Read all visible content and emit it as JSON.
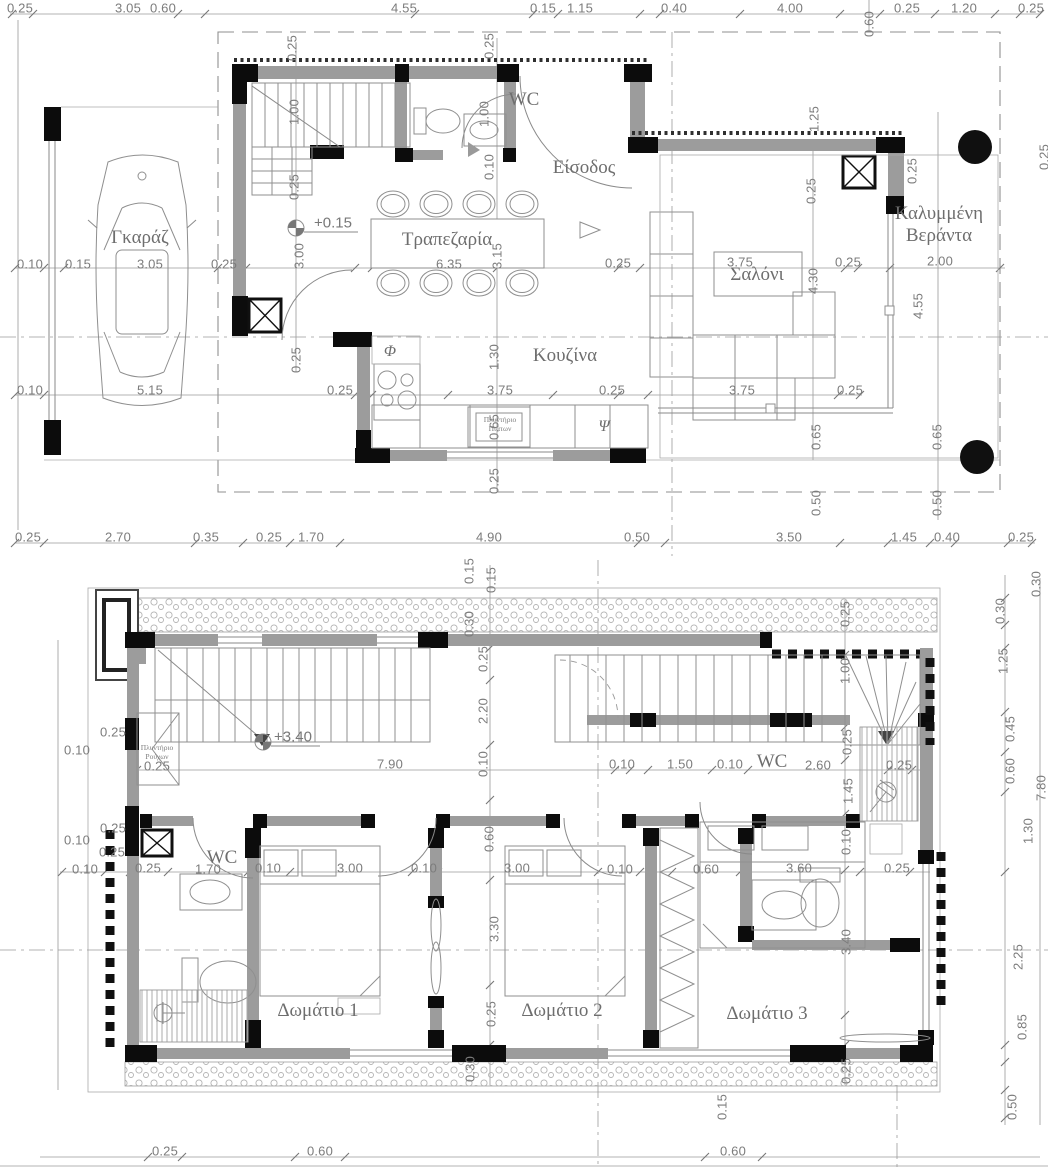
{
  "drawing": {
    "type": "architectural floor plans, two storeys",
    "colors": {
      "wall_black": "#0c0c0c",
      "wall_insulation_gray": "#9c9c9c",
      "line_gray": "#8a8a8a",
      "text_gray": "#7c7c7c"
    }
  },
  "ground_floor": {
    "rooms": [
      {
        "label": "Γκαράζ",
        "x": 140,
        "y": 238
      },
      {
        "label": "Τραπεζαρία",
        "x": 447,
        "y": 240
      },
      {
        "label": "WC",
        "x": 524,
        "y": 100
      },
      {
        "label": "Είσοδος",
        "x": 584,
        "y": 168
      },
      {
        "label": "Κουζίνα",
        "x": 565,
        "y": 356
      },
      {
        "label": "Σαλόνι",
        "x": 757,
        "y": 275
      },
      {
        "label": "Καλυμμένη\nΒεράντα",
        "x": 939,
        "y": 225
      }
    ],
    "fixtures": [
      {
        "label": "Πλυντήριο\nΠιάτων",
        "x": 500,
        "y": 424
      }
    ],
    "symbols": [
      {
        "t": "Φ",
        "x": 390,
        "y": 352
      },
      {
        "t": "Ψ",
        "x": 604,
        "y": 427
      }
    ],
    "level_marker": {
      "t": "+0.15",
      "x": 333,
      "y": 223
    },
    "dimensions": [
      {
        "t": "0.25",
        "x": 20,
        "y": 8
      },
      {
        "t": "3.05",
        "x": 128,
        "y": 8
      },
      {
        "t": "0.60",
        "x": 163,
        "y": 8
      },
      {
        "t": "4.55",
        "x": 404,
        "y": 8
      },
      {
        "t": "0.15",
        "x": 543,
        "y": 8
      },
      {
        "t": "1.15",
        "x": 580,
        "y": 8
      },
      {
        "t": "0.40",
        "x": 674,
        "y": 8
      },
      {
        "t": "4.00",
        "x": 790,
        "y": 8
      },
      {
        "t": "0.60",
        "x": 869,
        "y": 24,
        "v": 1
      },
      {
        "t": "0.25",
        "x": 907,
        "y": 8
      },
      {
        "t": "1.20",
        "x": 964,
        "y": 8
      },
      {
        "t": "0.25",
        "x": 1031,
        "y": 8
      },
      {
        "t": "0.25",
        "x": 292,
        "y": 48,
        "v": 1
      },
      {
        "t": "0.25",
        "x": 489,
        "y": 46,
        "v": 1
      },
      {
        "t": "1.00",
        "x": 294,
        "y": 112,
        "v": 1
      },
      {
        "t": "1.00",
        "x": 484,
        "y": 114,
        "v": 1
      },
      {
        "t": "0.25",
        "x": 294,
        "y": 187,
        "v": 1
      },
      {
        "t": "0.10",
        "x": 489,
        "y": 167,
        "v": 1
      },
      {
        "t": "1.25",
        "x": 814,
        "y": 119,
        "v": 1
      },
      {
        "t": "0.25",
        "x": 811,
        "y": 191,
        "v": 1
      },
      {
        "t": "0.25",
        "x": 912,
        "y": 171,
        "v": 1
      },
      {
        "t": "0.25",
        "x": 1044,
        "y": 157,
        "v": 1
      },
      {
        "t": "0.10",
        "x": 30,
        "y": 264
      },
      {
        "t": "0.15",
        "x": 78,
        "y": 264
      },
      {
        "t": "3.05",
        "x": 150,
        "y": 264
      },
      {
        "t": "0.25",
        "x": 224,
        "y": 264
      },
      {
        "t": "3.00",
        "x": 299,
        "y": 256,
        "v": 1
      },
      {
        "t": "6.35",
        "x": 449,
        "y": 264
      },
      {
        "t": "3.15",
        "x": 497,
        "y": 256,
        "v": 1
      },
      {
        "t": "0.25",
        "x": 618,
        "y": 263
      },
      {
        "t": "3.75",
        "x": 740,
        "y": 262
      },
      {
        "t": "0.25",
        "x": 848,
        "y": 262
      },
      {
        "t": "2.00",
        "x": 940,
        "y": 261
      },
      {
        "t": "4.30",
        "x": 813,
        "y": 281,
        "v": 1
      },
      {
        "t": "4.55",
        "x": 918,
        "y": 306,
        "v": 1
      },
      {
        "t": "0.25",
        "x": 296,
        "y": 360,
        "v": 1
      },
      {
        "t": "1.30",
        "x": 494,
        "y": 357,
        "v": 1
      },
      {
        "t": "0.10",
        "x": 30,
        "y": 390
      },
      {
        "t": "5.15",
        "x": 150,
        "y": 390
      },
      {
        "t": "0.25",
        "x": 340,
        "y": 390
      },
      {
        "t": "3.75",
        "x": 500,
        "y": 390
      },
      {
        "t": "0.25",
        "x": 612,
        "y": 390
      },
      {
        "t": "3.75",
        "x": 742,
        "y": 390
      },
      {
        "t": "0.25",
        "x": 850,
        "y": 390
      },
      {
        "t": "0.65",
        "x": 494,
        "y": 427,
        "v": 1
      },
      {
        "t": "0.25",
        "x": 494,
        "y": 481,
        "v": 1
      },
      {
        "t": "0.65",
        "x": 816,
        "y": 437,
        "v": 1
      },
      {
        "t": "0.65",
        "x": 937,
        "y": 437,
        "v": 1
      },
      {
        "t": "0.50",
        "x": 816,
        "y": 503,
        "v": 1
      },
      {
        "t": "0.50",
        "x": 937,
        "y": 503,
        "v": 1
      },
      {
        "t": "0.25",
        "x": 28,
        "y": 537
      },
      {
        "t": "2.70",
        "x": 118,
        "y": 537
      },
      {
        "t": "0.35",
        "x": 206,
        "y": 537
      },
      {
        "t": "0.25",
        "x": 269,
        "y": 537
      },
      {
        "t": "1.70",
        "x": 311,
        "y": 537
      },
      {
        "t": "4.90",
        "x": 489,
        "y": 537
      },
      {
        "t": "0.50",
        "x": 637,
        "y": 537
      },
      {
        "t": "3.50",
        "x": 789,
        "y": 537
      },
      {
        "t": "1.45",
        "x": 904,
        "y": 537
      },
      {
        "t": "0.40",
        "x": 947,
        "y": 537
      },
      {
        "t": "0.25",
        "x": 1021,
        "y": 537
      }
    ]
  },
  "upper_floor": {
    "rooms": [
      {
        "label": "WC",
        "x": 222,
        "y": 858
      },
      {
        "label": "WC",
        "x": 772,
        "y": 762
      },
      {
        "label": "Δωμάτιο 1",
        "x": 318,
        "y": 1011
      },
      {
        "label": "Δωμάτιο 2",
        "x": 562,
        "y": 1011
      },
      {
        "label": "Δωμάτιο 3",
        "x": 767,
        "y": 1014
      }
    ],
    "fixtures": [
      {
        "label": "Πλυντήριο\nΡούχων",
        "x": 157,
        "y": 752
      }
    ],
    "symbols": [],
    "level_marker": {
      "t": "+3.40",
      "x": 293,
      "y": 737
    },
    "dimensions": [
      {
        "t": "0.15",
        "x": 469,
        "y": 571,
        "v": 1
      },
      {
        "t": "0.15",
        "x": 491,
        "y": 580,
        "v": 1
      },
      {
        "t": "0.30",
        "x": 469,
        "y": 624,
        "v": 1
      },
      {
        "t": "0.25",
        "x": 483,
        "y": 659,
        "v": 1
      },
      {
        "t": "2.20",
        "x": 483,
        "y": 711,
        "v": 1
      },
      {
        "t": "0.10",
        "x": 483,
        "y": 764,
        "v": 1
      },
      {
        "t": "0.25",
        "x": 113,
        "y": 732
      },
      {
        "t": "0.10",
        "x": 77,
        "y": 750
      },
      {
        "t": "0.25",
        "x": 157,
        "y": 766
      },
      {
        "t": "0.25",
        "x": 113,
        "y": 828
      },
      {
        "t": "0.10",
        "x": 77,
        "y": 840
      },
      {
        "t": "0.25",
        "x": 112,
        "y": 852
      },
      {
        "t": "7.90",
        "x": 390,
        "y": 764
      },
      {
        "t": "0.10",
        "x": 622,
        "y": 764
      },
      {
        "t": "1.50",
        "x": 680,
        "y": 764
      },
      {
        "t": "0.10",
        "x": 730,
        "y": 764
      },
      {
        "t": "2.60",
        "x": 818,
        "y": 765
      },
      {
        "t": "0.25",
        "x": 899,
        "y": 765
      },
      {
        "t": "0.25",
        "x": 845,
        "y": 614,
        "v": 1
      },
      {
        "t": "1.00",
        "x": 845,
        "y": 671,
        "v": 1
      },
      {
        "t": "0.25",
        "x": 847,
        "y": 742,
        "v": 1
      },
      {
        "t": "1.45",
        "x": 848,
        "y": 791,
        "v": 1
      },
      {
        "t": "0.10",
        "x": 85,
        "y": 869
      },
      {
        "t": "0.25",
        "x": 148,
        "y": 868
      },
      {
        "t": "1.70",
        "x": 208,
        "y": 869
      },
      {
        "t": "0.10",
        "x": 268,
        "y": 868
      },
      {
        "t": "3.00",
        "x": 350,
        "y": 868
      },
      {
        "t": "0.10",
        "x": 424,
        "y": 868
      },
      {
        "t": "3.00",
        "x": 517,
        "y": 868
      },
      {
        "t": "0.10",
        "x": 620,
        "y": 869
      },
      {
        "t": "0.60",
        "x": 706,
        "y": 869
      },
      {
        "t": "3.60",
        "x": 799,
        "y": 868
      },
      {
        "t": "0.25",
        "x": 897,
        "y": 868
      },
      {
        "t": "0.60",
        "x": 489,
        "y": 839,
        "v": 1
      },
      {
        "t": "3.30",
        "x": 494,
        "y": 929,
        "v": 1
      },
      {
        "t": "0.25",
        "x": 491,
        "y": 1014,
        "v": 1
      },
      {
        "t": "0.30",
        "x": 470,
        "y": 1069,
        "v": 1
      },
      {
        "t": "0.10",
        "x": 846,
        "y": 842,
        "v": 1
      },
      {
        "t": "3.40",
        "x": 846,
        "y": 942,
        "v": 1
      },
      {
        "t": "0.25",
        "x": 846,
        "y": 1071,
        "v": 1
      },
      {
        "t": "0.30",
        "x": 1036,
        "y": 584,
        "v": 1
      },
      {
        "t": "0.30",
        "x": 1000,
        "y": 611,
        "v": 1
      },
      {
        "t": "1.25",
        "x": 1003,
        "y": 661,
        "v": 1
      },
      {
        "t": "0.45",
        "x": 1010,
        "y": 729,
        "v": 1
      },
      {
        "t": "0.60",
        "x": 1010,
        "y": 771,
        "v": 1
      },
      {
        "t": "1.30",
        "x": 1028,
        "y": 831,
        "v": 1
      },
      {
        "t": "7.80",
        "x": 1041,
        "y": 788,
        "v": 1
      },
      {
        "t": "2.25",
        "x": 1018,
        "y": 957,
        "v": 1
      },
      {
        "t": "0.85",
        "x": 1022,
        "y": 1027,
        "v": 1
      },
      {
        "t": "0.50",
        "x": 1012,
        "y": 1107,
        "v": 1
      },
      {
        "t": "0.25",
        "x": 165,
        "y": 1151
      },
      {
        "t": "0.60",
        "x": 320,
        "y": 1151
      },
      {
        "t": "0.60",
        "x": 733,
        "y": 1151
      },
      {
        "t": "0.15",
        "x": 722,
        "y": 1107,
        "v": 1
      }
    ]
  }
}
